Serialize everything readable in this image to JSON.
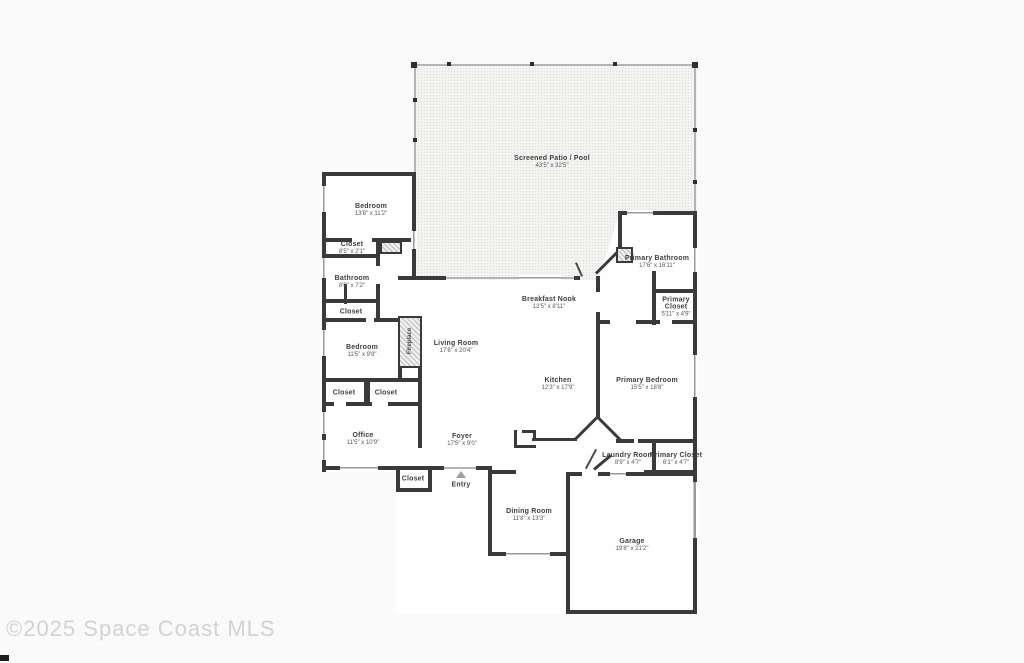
{
  "watermark": "©2025 Space Coast MLS",
  "colors": {
    "wall": "#3a3a3a",
    "patio_fill": "#f3f3f2",
    "label_text": "#3f3f3f",
    "watermark_text": "#d2d2d2"
  },
  "rooms": {
    "patio": {
      "name": "Screened Patio / Pool",
      "dims": "43'5\" x 32'5\""
    },
    "bedroom1": {
      "name": "Bedroom",
      "dims": "13'8\" x 11'2\""
    },
    "closet1": {
      "name": "Closet",
      "dims": "8'5\" x 2'1\""
    },
    "bathroom": {
      "name": "Bathroom",
      "dims": "8'0\" x 7'2\""
    },
    "closet2": {
      "name": "Closet"
    },
    "bedroom2": {
      "name": "Bedroom",
      "dims": "11'5\" x 9'8\""
    },
    "fireplace": {
      "name": "Fireplace"
    },
    "living": {
      "name": "Living Room",
      "dims": "17'6\" x 20'4\""
    },
    "breakfast": {
      "name": "Breakfast Nook",
      "dims": "12'5\" x 8'11\""
    },
    "kitchen": {
      "name": "Kitchen",
      "dims": "12'3\" x 17'9\""
    },
    "primary_bath": {
      "name": "Primary Bathroom",
      "dims": "17'6\" x 16'11\""
    },
    "primary_closet1": {
      "name": "Primary Closet",
      "dims": "5'11\" x 4'9\""
    },
    "primary_bedroom": {
      "name": "Primary Bedroom",
      "dims": "15'5\" x 18'8\""
    },
    "closet3": {
      "name": "Closet"
    },
    "closet4": {
      "name": "Closet"
    },
    "office": {
      "name": "Office",
      "dims": "11'5\" x 10'9\""
    },
    "foyer": {
      "name": "Foyer",
      "dims": "17'5\" x 9'0\""
    },
    "closet5": {
      "name": "Closet"
    },
    "entry": {
      "name": "Entry"
    },
    "laundry": {
      "name": "Laundry Room",
      "dims": "8'9\" x 4'7\""
    },
    "primary_closet2": {
      "name": "Primary Closet",
      "dims": "6'1\" x 4'7\""
    },
    "dining": {
      "name": "Dining Room",
      "dims": "11'8\" x 13'3\""
    },
    "garage": {
      "name": "Garage",
      "dims": "19'8\" x 21'2\""
    }
  }
}
